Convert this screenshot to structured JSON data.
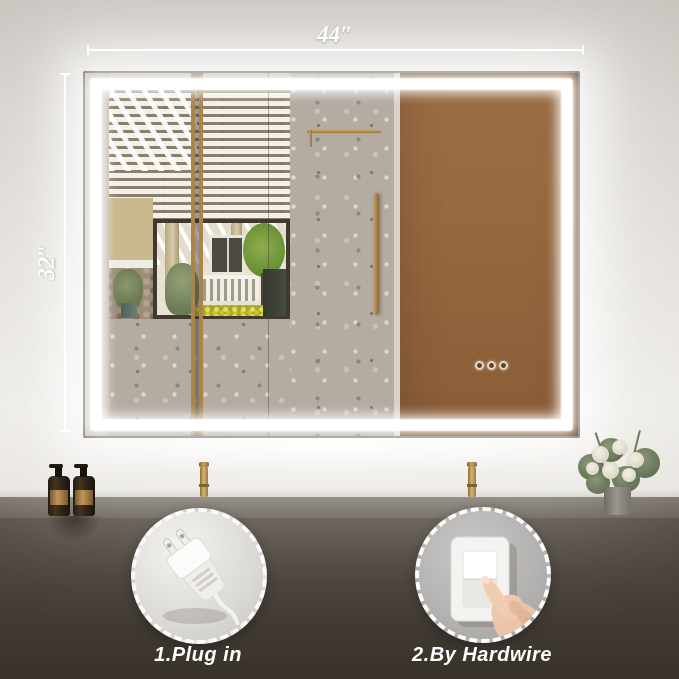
{
  "annotations": {
    "width_label": "44″",
    "height_label": "32″"
  },
  "instructions": {
    "option1": {
      "label": "1.Plug in",
      "icon": "power-plug-icon"
    },
    "option2": {
      "label": "2.By Hardwire",
      "icon": "wall-switch-icon"
    }
  },
  "mirror": {
    "type": "LED backlit bathroom mirror",
    "touch_buttons": [
      "touch-button-1",
      "touch-button-2",
      "touch-button-3"
    ]
  },
  "colors": {
    "led_light": "#ffffff",
    "door_brown": "#96683f",
    "gold_accent": "#b08b4e",
    "counter_dark": "#48413a",
    "wall_light": "#e2dfd9"
  }
}
